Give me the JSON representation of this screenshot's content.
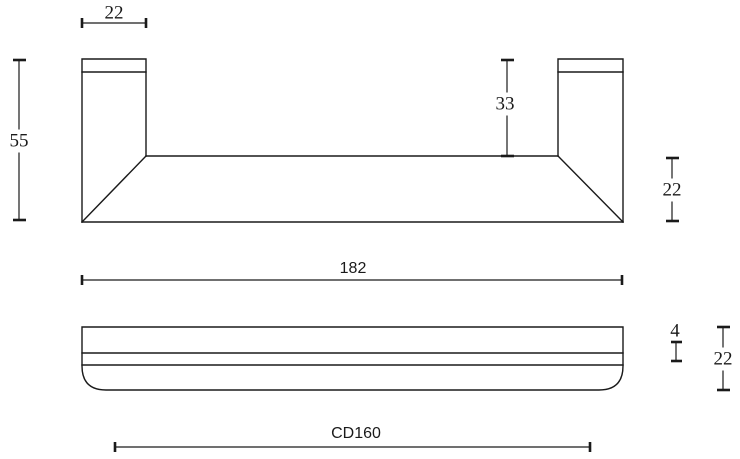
{
  "drawing": {
    "type": "technical-dimension-drawing",
    "front_view": {
      "dim_post_width": "22",
      "dim_total_height": "55",
      "dim_post_height": "33",
      "dim_bar_height": "22"
    },
    "side_view": {
      "dim_length": "182",
      "dim_groove": "4",
      "dim_height": "22",
      "dim_center_distance": "CD160"
    },
    "colors": {
      "line": "#1a1a1a",
      "background": "#ffffff"
    }
  }
}
